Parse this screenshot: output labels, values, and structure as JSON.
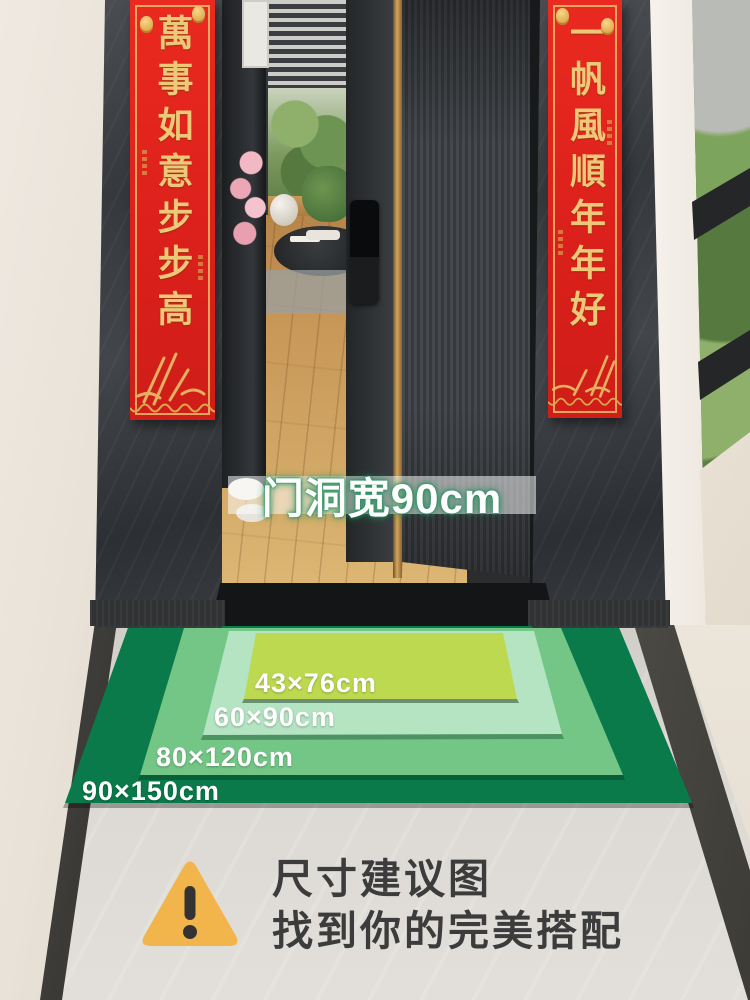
{
  "couplets": {
    "left": {
      "text": "萬事如意步步高"
    },
    "right": {
      "text": "一帆風順年年好"
    },
    "red": "#e2231d",
    "gold": "#ecc878"
  },
  "door_label": {
    "text": "门洞宽90cm",
    "text_color": "#ffffff",
    "glow_color": "#248f5d"
  },
  "mats": [
    {
      "label": "90×150cm",
      "color": "#0a7a4a"
    },
    {
      "label": "80×120cm",
      "color": "#74c687"
    },
    {
      "label": "60×90cm",
      "color": "#b5e4c3"
    },
    {
      "label": "43×76cm",
      "color": "#bdd950"
    }
  ],
  "caption": {
    "line1": "尺寸建议图",
    "line2": "找到你的完美搭配",
    "icon_color": "#f2b54b",
    "text_color": "#3c3c3c"
  }
}
